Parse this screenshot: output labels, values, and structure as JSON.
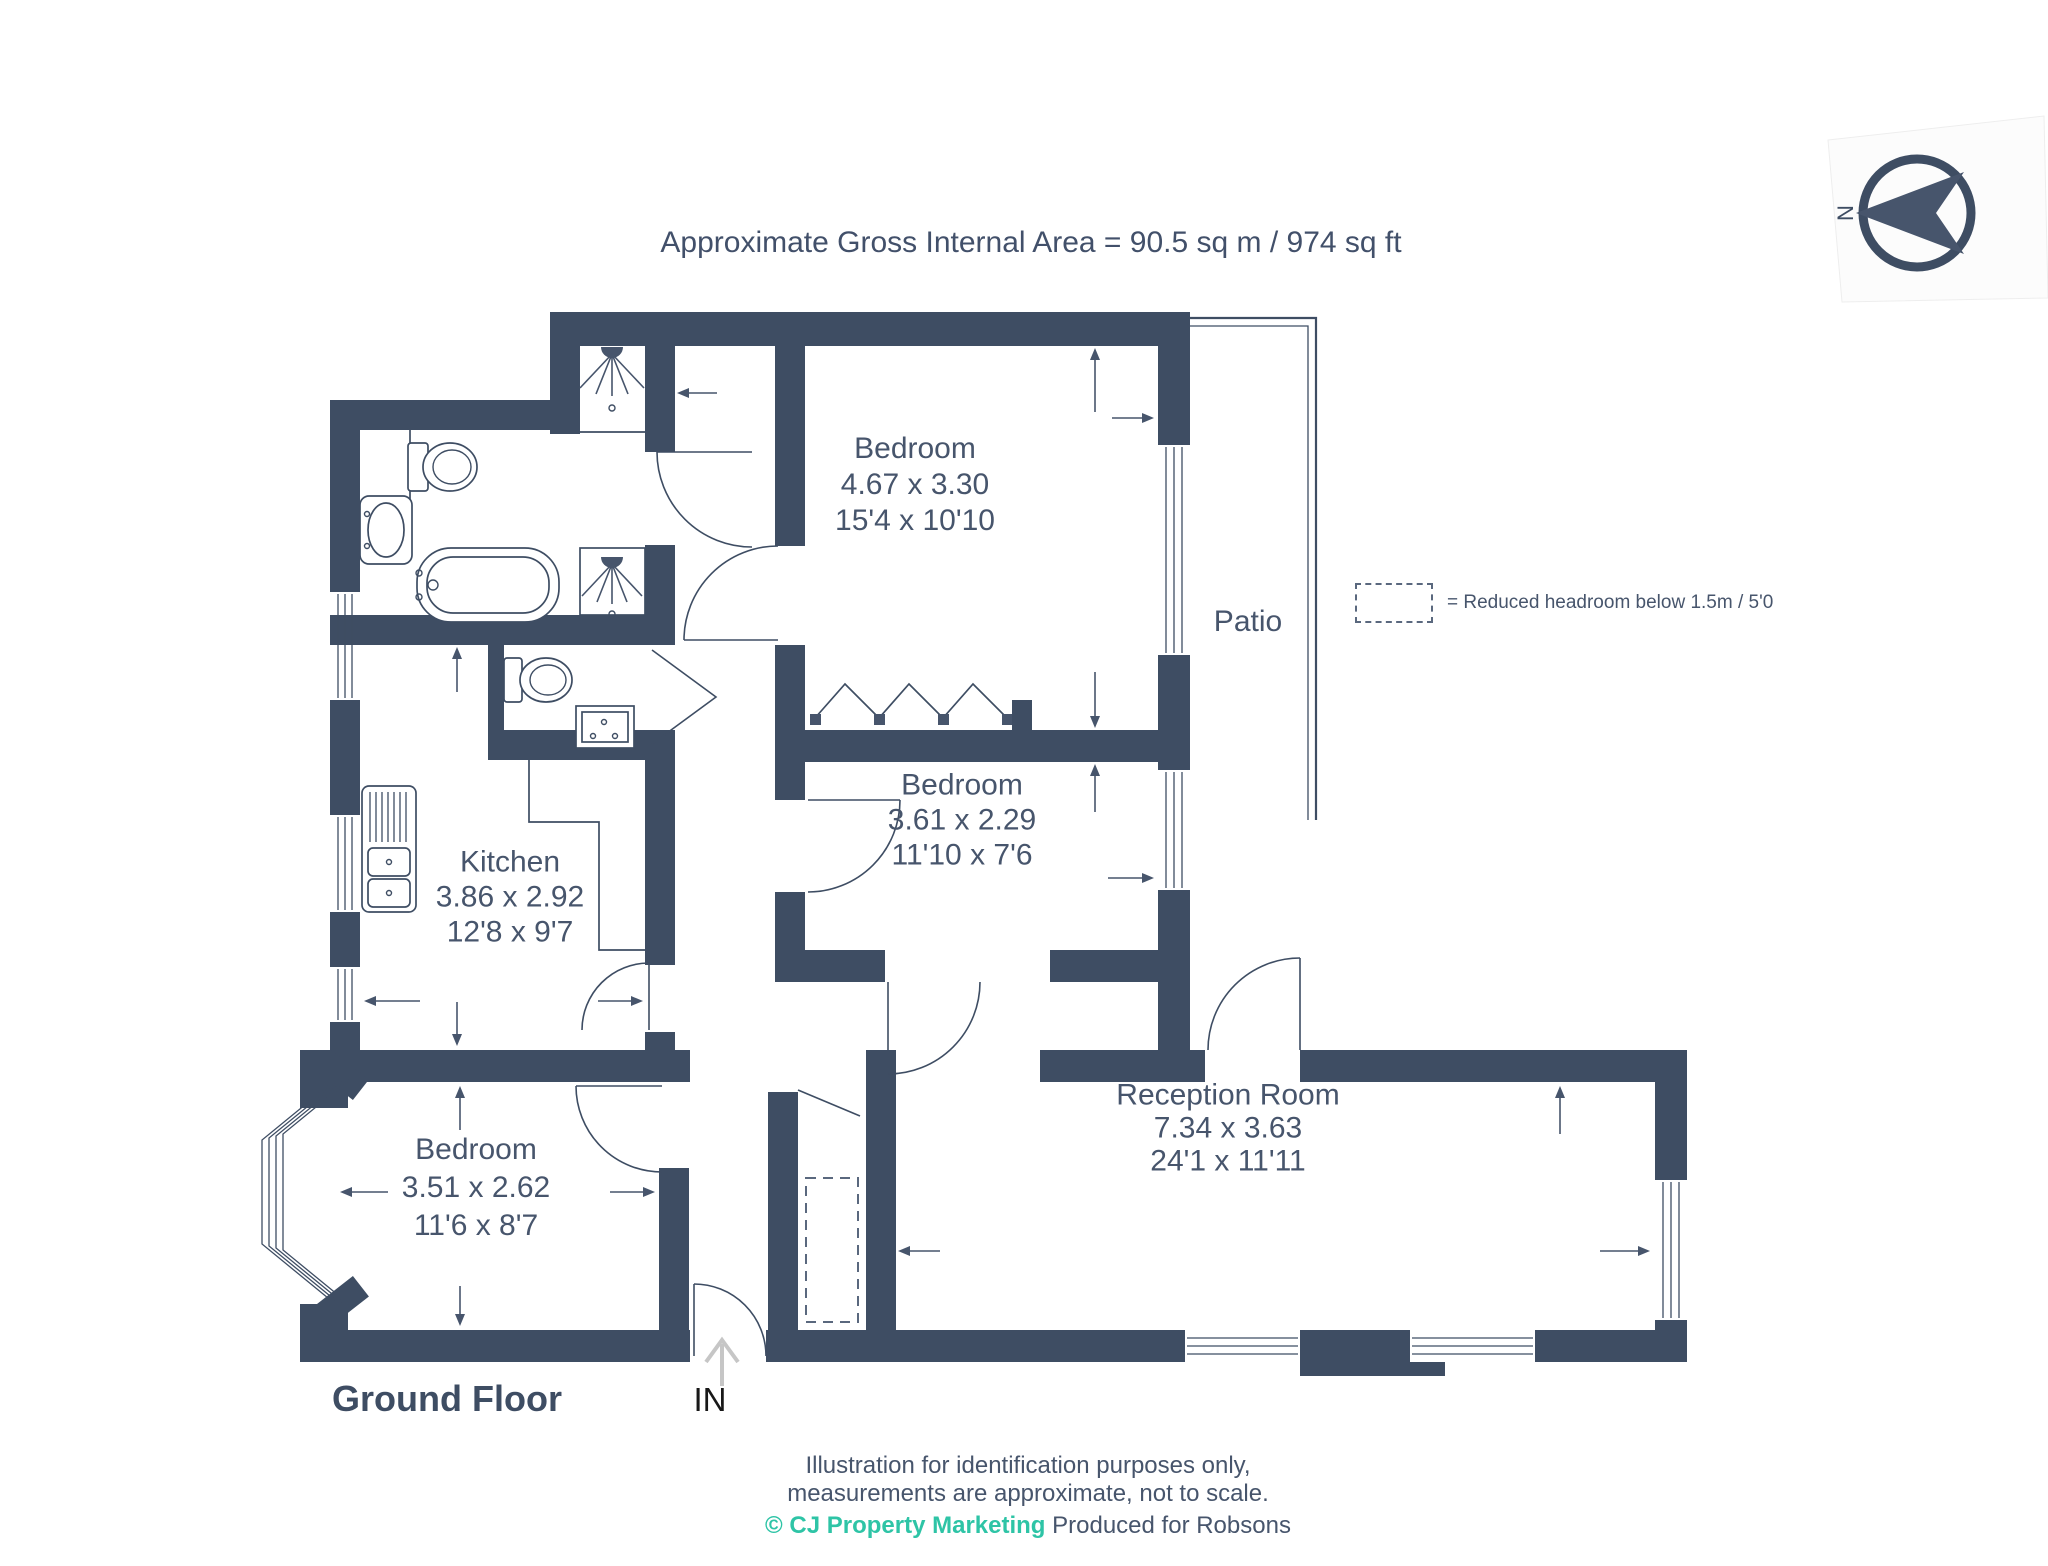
{
  "title": "Approximate Gross Internal Area = 90.5 sq m / 974 sq ft",
  "compass": {
    "north_label": "N"
  },
  "legend": {
    "text": "= Reduced headroom below 1.5m / 5'0"
  },
  "floor_label": "Ground Floor",
  "entrance_label": "IN",
  "patio_label": "Patio",
  "rooms": [
    {
      "id": "bedroom-1",
      "name": "Bedroom",
      "metric": "4.67 x 3.30",
      "imperial": "15'4 x 10'10"
    },
    {
      "id": "bedroom-2",
      "name": "Bedroom",
      "metric": "3.61 x 2.29",
      "imperial": "11'10 x 7'6"
    },
    {
      "id": "kitchen",
      "name": "Kitchen",
      "metric": "3.86 x 2.92",
      "imperial": "12'8 x 9'7"
    },
    {
      "id": "bedroom-3",
      "name": "Bedroom",
      "metric": "3.51 x 2.62",
      "imperial": "11'6 x 8'7"
    },
    {
      "id": "reception-room",
      "name": "Reception Room",
      "metric": "7.34 x 3.63",
      "imperial": "24'1 x 11'11"
    }
  ],
  "footer": {
    "line1": "Illustration for identification purposes only,",
    "line2": "measurements are approximate, not to scale.",
    "credit": "© CJ Property Marketing",
    "produced": "Produced for Robsons"
  },
  "colors": {
    "wall": "#3E4D63",
    "text": "#47556C",
    "accent_teal": "#2EC4A6"
  }
}
